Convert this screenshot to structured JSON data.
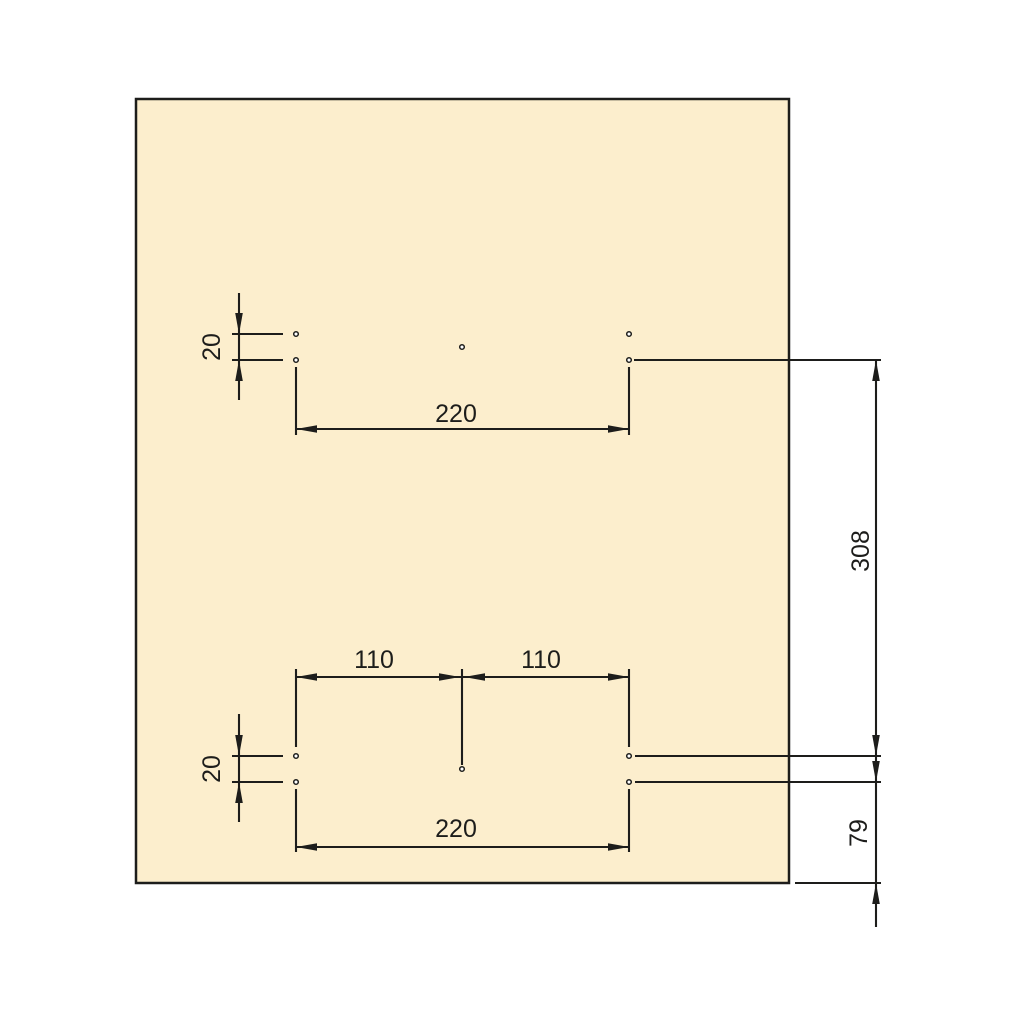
{
  "drawing": {
    "background_color": "#ffffff",
    "line_color": "#1d1d1b",
    "panel": {
      "fill_color": "#fceecd",
      "stroke_color": "#1d1d1b"
    },
    "dimension_labels": {
      "top_row_gap": "20",
      "top_span": "220",
      "bottom_left_half": "110",
      "bottom_right_half": "110",
      "bottom_row_gap": "20",
      "bottom_span": "220",
      "between_groups": "308",
      "bottom_edge_offset": "79"
    },
    "hole_groups": {
      "top_hole_count": 5,
      "bottom_hole_count": 5
    }
  }
}
